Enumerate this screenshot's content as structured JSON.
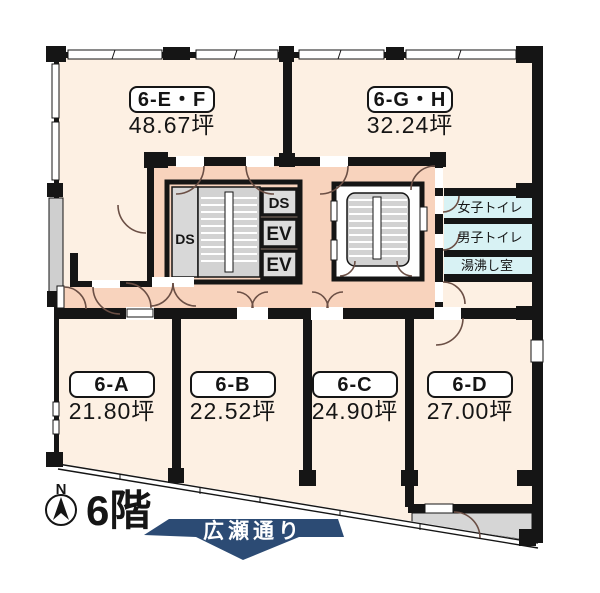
{
  "floor_plan": {
    "floor_label": "6階",
    "compass_label": "N",
    "street_banner": "広瀬通り",
    "rooms": {
      "ef": {
        "id": "6-E・F",
        "area": "48.67坪"
      },
      "gh": {
        "id": "6-G・H",
        "area": "32.24坪"
      },
      "a": {
        "id": "6-A",
        "area": "21.80坪"
      },
      "b": {
        "id": "6-B",
        "area": "22.52坪"
      },
      "c": {
        "id": "6-C",
        "area": "24.90坪"
      },
      "d": {
        "id": "6-D",
        "area": "27.00坪"
      }
    },
    "facilities": {
      "womens_toilet": "女子トイレ",
      "mens_toilet": "男子トイレ",
      "kitchenette": "湯沸し室"
    },
    "core": {
      "ds": "DS",
      "ev": "EV"
    },
    "colors": {
      "room_fill": "#fdf0e3",
      "corridor_fill": "#f8d3bd",
      "toilet_fill": "#d8f2f4",
      "highlight_red": "#e62619",
      "banner_navy": "#2c4b74"
    }
  }
}
